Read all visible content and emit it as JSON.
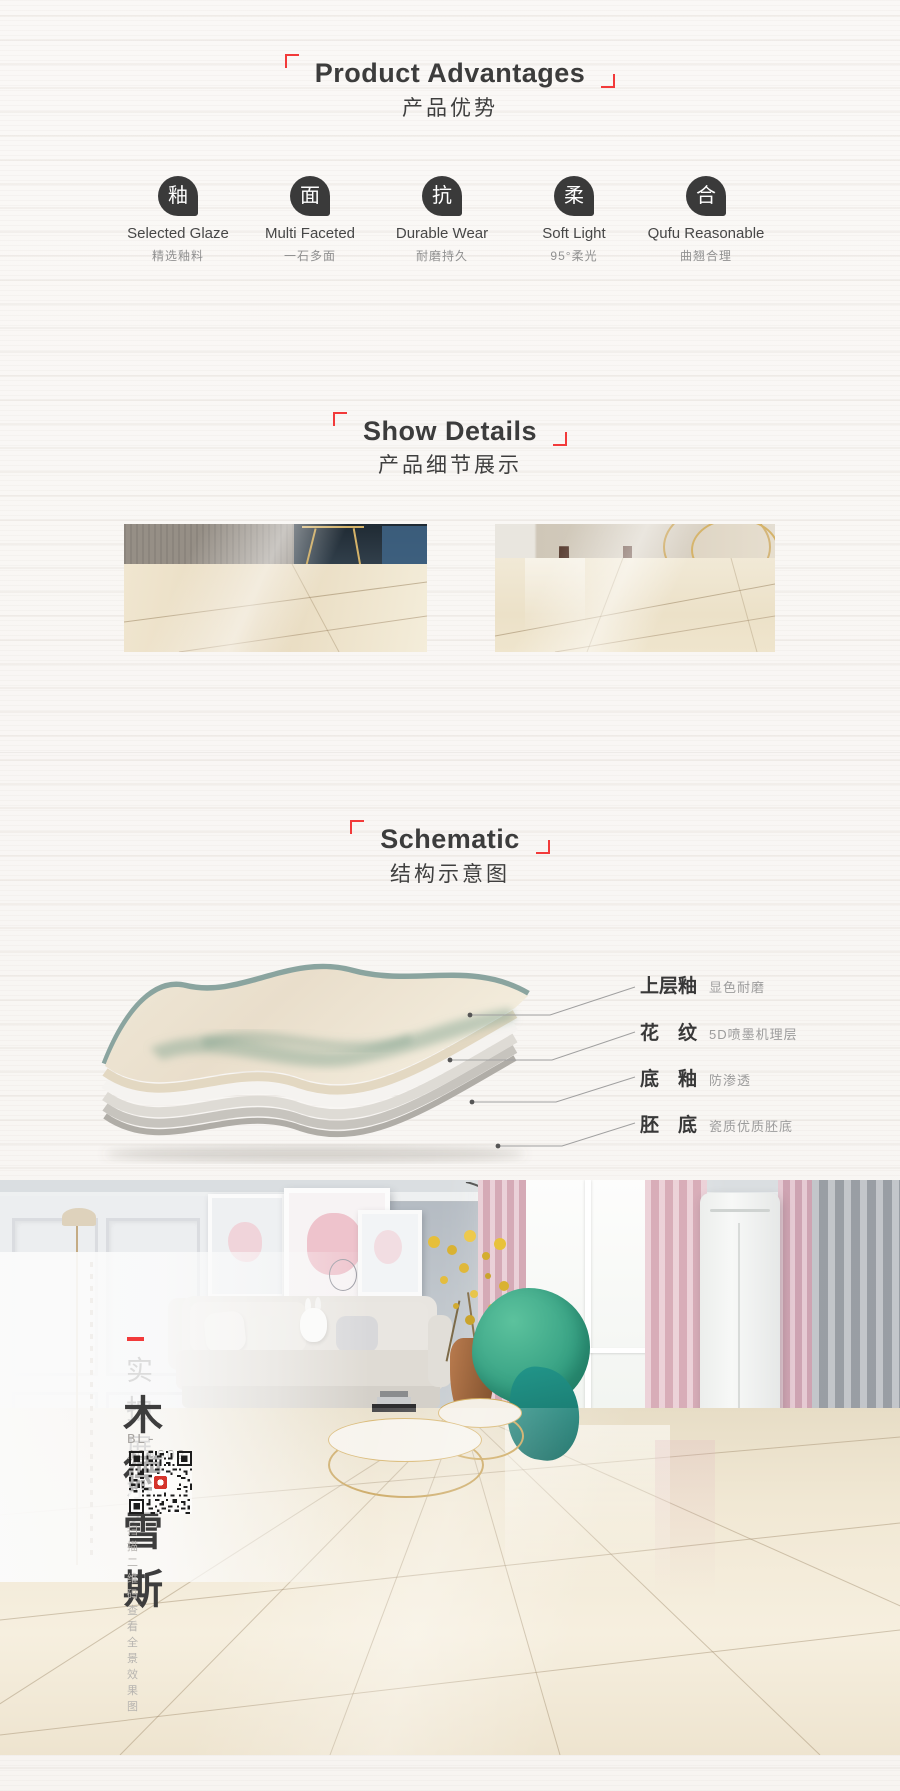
{
  "colors": {
    "accent": "#f23a3a",
    "icon_bg": "#3a3a3a",
    "glaze_teal": "#8aa49f",
    "marble_beige": "#efe5cf"
  },
  "advantages": {
    "title_en": "Product Advantages",
    "title_zh": "产品优势",
    "items": [
      {
        "icon_char": "釉",
        "en": "Selected Glaze",
        "zh": "精选釉料"
      },
      {
        "icon_char": "面",
        "en": "Multi Faceted",
        "zh": "一石多面"
      },
      {
        "icon_char": "抗",
        "en": "Durable Wear",
        "zh": "耐磨持久"
      },
      {
        "icon_char": "柔",
        "en": "Soft Light",
        "zh": "95°柔光"
      },
      {
        "icon_char": "合",
        "en": "Qufu Reasonable",
        "zh": "曲翘合理"
      }
    ]
  },
  "details": {
    "title_en": "Show Details",
    "title_zh": "产品细节展示"
  },
  "schematic": {
    "title_en": "Schematic",
    "title_zh": "结构示意图",
    "layers": [
      {
        "name": "上层釉",
        "desc": "显色耐磨"
      },
      {
        "name": "花　纹",
        "desc": "5D喷墨机理层"
      },
      {
        "name": "底　釉",
        "desc": "防渗透"
      },
      {
        "name": "胚　底",
        "desc": "瓷质优质胚底"
      }
    ]
  },
  "showcase": {
    "label": "实拍展示2",
    "product_name": "木德雪斯",
    "model": "BL-1C8002",
    "qr_caption": "扫描二维码查看全景效果图"
  }
}
